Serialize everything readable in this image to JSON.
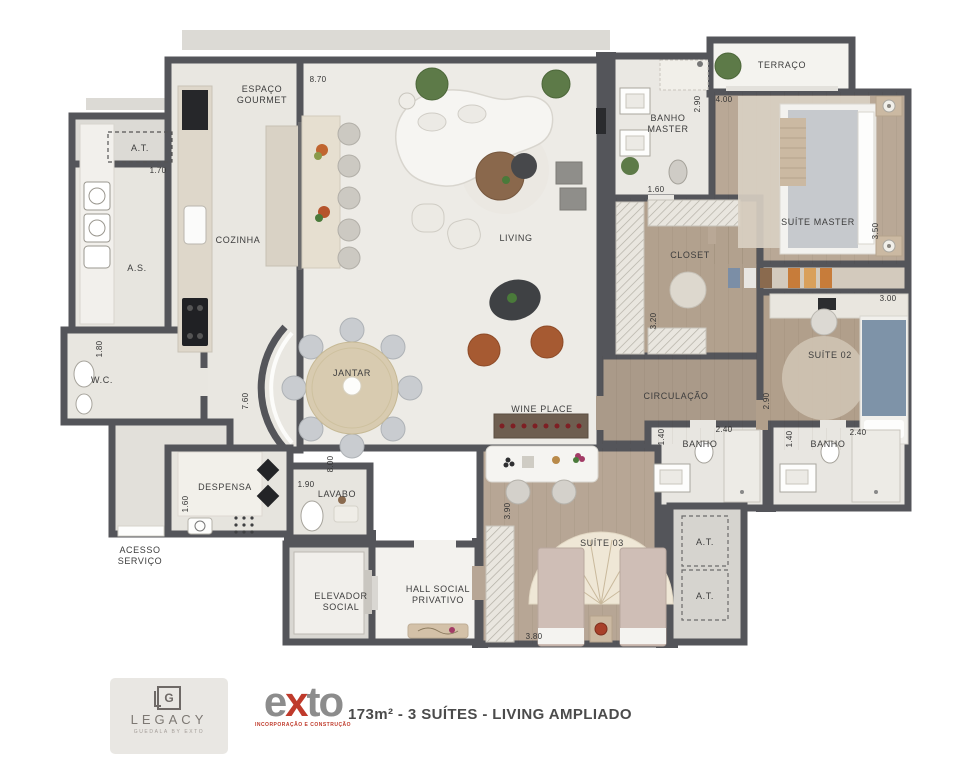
{
  "plan": {
    "labels": [
      {
        "text": "ESPAÇO",
        "x": 262,
        "y": 92
      },
      {
        "text": "GOURMET",
        "x": 262,
        "y": 103
      },
      {
        "text": "COZINHA",
        "x": 238,
        "y": 243
      },
      {
        "text": "A.T.",
        "x": 140,
        "y": 151
      },
      {
        "text": "A.S.",
        "x": 137,
        "y": 271
      },
      {
        "text": "W.C.",
        "x": 102,
        "y": 383
      },
      {
        "text": "DESPENSA",
        "x": 225,
        "y": 490
      },
      {
        "text": "ACESSO",
        "x": 140,
        "y": 553
      },
      {
        "text": "SERVIÇO",
        "x": 140,
        "y": 564
      },
      {
        "text": "LAVABO",
        "x": 337,
        "y": 497
      },
      {
        "text": "ELEVADOR",
        "x": 341,
        "y": 599
      },
      {
        "text": "SOCIAL",
        "x": 341,
        "y": 610
      },
      {
        "text": "HALL SOCIAL",
        "x": 438,
        "y": 592
      },
      {
        "text": "PRIVATIVO",
        "x": 438,
        "y": 603
      },
      {
        "text": "JANTAR",
        "x": 352,
        "y": 376
      },
      {
        "text": "LIVING",
        "x": 516,
        "y": 241
      },
      {
        "text": "WINE PLACE",
        "x": 542,
        "y": 412
      },
      {
        "text": "BANHO",
        "x": 668,
        "y": 121
      },
      {
        "text": "MASTER",
        "x": 668,
        "y": 132
      },
      {
        "text": "TERRAÇO",
        "x": 782,
        "y": 68
      },
      {
        "text": "SUÍTE MASTER",
        "x": 818,
        "y": 225
      },
      {
        "text": "CLOSET",
        "x": 690,
        "y": 258
      },
      {
        "text": "CIRCULAÇÃO",
        "x": 676,
        "y": 399
      },
      {
        "text": "SUÍTE 02",
        "x": 830,
        "y": 358
      },
      {
        "text": "BANHO",
        "x": 700,
        "y": 447
      },
      {
        "text": "BANHO",
        "x": 828,
        "y": 447
      },
      {
        "text": "SUÍTE 03",
        "x": 602,
        "y": 546
      },
      {
        "text": "A.T.",
        "x": 705,
        "y": 545
      },
      {
        "text": "A.T.",
        "x": 705,
        "y": 599
      }
    ],
    "dimensions": [
      {
        "text": "8.70",
        "x": 318,
        "y": 82,
        "rot": 0
      },
      {
        "text": "1.70",
        "x": 158,
        "y": 173,
        "rot": 0
      },
      {
        "text": "2.90",
        "x": 700,
        "y": 104,
        "rot": -90
      },
      {
        "text": "4.00",
        "x": 724,
        "y": 102,
        "rot": 0
      },
      {
        "text": "1.60",
        "x": 656,
        "y": 192,
        "rot": 0
      },
      {
        "text": "3.50",
        "x": 878,
        "y": 231,
        "rot": -90
      },
      {
        "text": "3.00",
        "x": 888,
        "y": 301,
        "rot": 0
      },
      {
        "text": "3.20",
        "x": 656,
        "y": 321,
        "rot": -90
      },
      {
        "text": "2.90",
        "x": 769,
        "y": 401,
        "rot": -90
      },
      {
        "text": "7.60",
        "x": 248,
        "y": 401,
        "rot": -90
      },
      {
        "text": "8.00",
        "x": 333,
        "y": 464,
        "rot": -90
      },
      {
        "text": "1.80",
        "x": 102,
        "y": 349,
        "rot": -90
      },
      {
        "text": "1.60",
        "x": 188,
        "y": 504,
        "rot": -90
      },
      {
        "text": "1.90",
        "x": 306,
        "y": 487,
        "rot": 0
      },
      {
        "text": "3.90",
        "x": 510,
        "y": 511,
        "rot": -90
      },
      {
        "text": "1.40",
        "x": 664,
        "y": 437,
        "rot": -90
      },
      {
        "text": "2.40",
        "x": 724,
        "y": 432,
        "rot": 0
      },
      {
        "text": "1.40",
        "x": 792,
        "y": 439,
        "rot": -90
      },
      {
        "text": "2.40",
        "x": 858,
        "y": 435,
        "rot": 0
      },
      {
        "text": "3.80",
        "x": 534,
        "y": 639,
        "rot": 0
      }
    ]
  },
  "branding": {
    "legacy_monogram": "G",
    "legacy_name": "LEGACY",
    "legacy_tagline": "GUEDALA BY EXTO",
    "exto_e": "e",
    "exto_x": "x",
    "exto_to": "to",
    "exto_subtitle": "INCORPORAÇÃO E CONSTRUÇÃO",
    "caption": "173m² - 3 SUÍTES - LIVING AMPLIADO"
  },
  "colors": {
    "wall": "#54555a",
    "light_floor": "#edebe6",
    "wood_floor": "#b2a18e",
    "accent_red": "#bf3a2b",
    "terracotta": "#a65a32",
    "bed_blue": "#7e93a8"
  }
}
